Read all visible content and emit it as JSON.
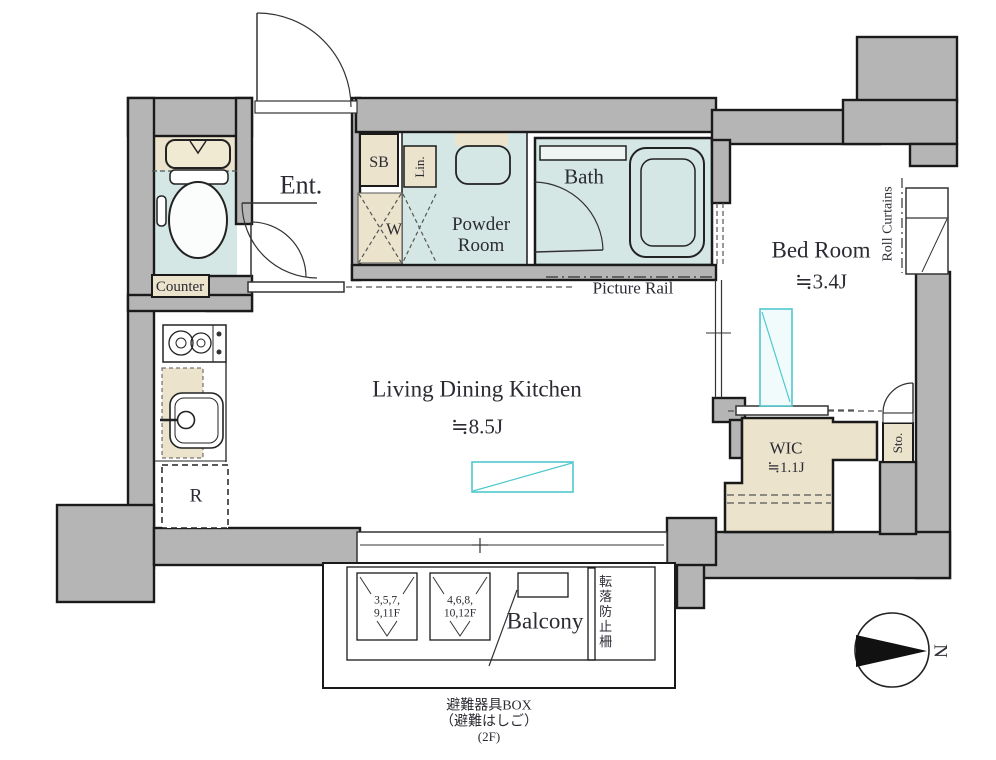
{
  "colors": {
    "wall_gray": "#b5b5b5",
    "wet_area_blue": "#d5e7e4",
    "cabinet_beige": "#ebe3cb",
    "accent_cyan": "#4fc8cf",
    "outline_black": "#1a1a1a"
  },
  "rooms": {
    "entrance": {
      "label": "Ent."
    },
    "toilet_counter": {
      "label": "Counter"
    },
    "shoe_box": {
      "label": "SB"
    },
    "linen": {
      "label": "Lin."
    },
    "washer": {
      "label": "W"
    },
    "powder_room": {
      "label": "Powder Room"
    },
    "bath": {
      "label": "Bath"
    },
    "bedroom": {
      "label": "Bed Room",
      "size": "≒3.4J"
    },
    "ldk": {
      "label": "Living Dining Kitchen",
      "size": "≒8.5J"
    },
    "wic": {
      "label": "WIC",
      "size": "≒1.1J"
    },
    "storage": {
      "label": "Sto."
    },
    "refrigerator": {
      "label": "R"
    },
    "balcony": {
      "label": "Balcony"
    }
  },
  "annotations": {
    "picture_rail": "Picture Rail",
    "roll_curtains": "Roll Curtains",
    "hatch_odd_floors_line1": "3,5,7,",
    "hatch_odd_floors_line2": "9,11F",
    "hatch_even_floors_line1": "4,6,8,",
    "hatch_even_floors_line2": "10,12F",
    "fall_prevention_fence": "転落防止柵",
    "evacuation_box_line1": "避難器具BOX",
    "evacuation_box_line2": "（避難はしご）",
    "evacuation_box_line3": "(2F)",
    "compass_north": "N"
  }
}
